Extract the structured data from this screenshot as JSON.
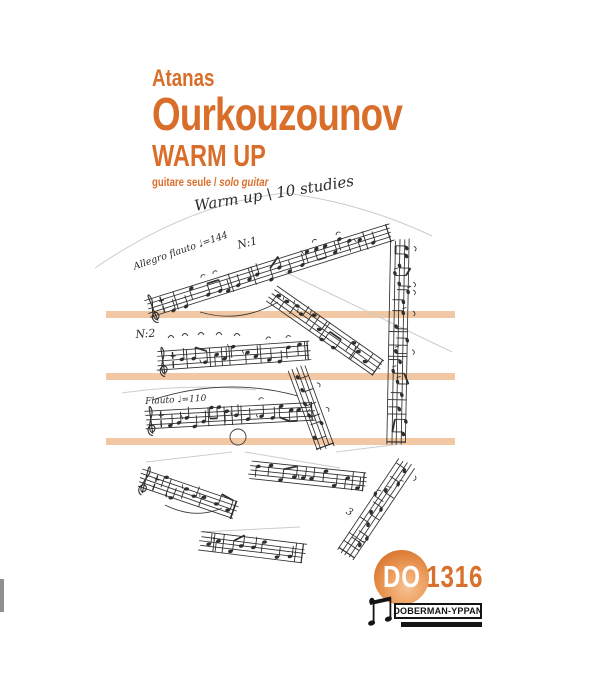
{
  "page": {
    "accent_color": "#d96e2a",
    "band_color": "#f2c7a3",
    "ink_color": "#2e2e2e",
    "background": "#ffffff"
  },
  "header": {
    "author_first": "Atanas",
    "author_last": "Ourkouzounov",
    "title": "WARM UP",
    "subtitle_fr": "guitare seule",
    "subtitle_sep": " / ",
    "subtitle_en": "solo guitar"
  },
  "manuscript": {
    "labels": [
      {
        "text": "Warm up \\ 10 studies",
        "x": 193,
        "y": 197,
        "rot": -9,
        "size": 15
      },
      {
        "text": "N:1",
        "x": 236,
        "y": 239,
        "rot": -14,
        "size": 11
      },
      {
        "text": "Allegro flauto ♩=144",
        "x": 132,
        "y": 262,
        "rot": -19,
        "size": 9.5
      },
      {
        "text": "N:2",
        "x": 135,
        "y": 328,
        "rot": -4,
        "size": 11
      },
      {
        "text": "Flauto ♩=110",
        "x": 145,
        "y": 397,
        "rot": -3,
        "size": 9
      },
      {
        "text": "3",
        "x": 349,
        "y": 506,
        "rot": 28,
        "size": 10
      }
    ],
    "staves": [
      {
        "x": 148,
        "y": 309,
        "angle": -17.5,
        "len": 252,
        "clef": true,
        "seed": 1
      },
      {
        "x": 400,
        "y": 240,
        "angle": 91,
        "len": 202,
        "clef": false,
        "seed": 2
      },
      {
        "x": 271,
        "y": 293,
        "angle": 35,
        "len": 130,
        "clef": false,
        "seed": 3
      },
      {
        "x": 158,
        "y": 361,
        "angle": -4,
        "len": 150,
        "clef": true,
        "seed": 4
      },
      {
        "x": 297,
        "y": 369,
        "angle": 70,
        "len": 82,
        "clef": false,
        "seed": 5
      },
      {
        "x": 146,
        "y": 420,
        "angle": -3,
        "len": 166,
        "clef": true,
        "seed": 6
      },
      {
        "x": 141,
        "y": 478,
        "angle": 19,
        "len": 98,
        "clef": true,
        "seed": 7
      },
      {
        "x": 250,
        "y": 470,
        "angle": 6,
        "len": 114,
        "clef": false,
        "seed": 8
      },
      {
        "x": 407,
        "y": 463,
        "angle": 124,
        "len": 108,
        "clef": false,
        "seed": 9
      },
      {
        "x": 201,
        "y": 541,
        "angle": 7,
        "len": 102,
        "clef": false,
        "seed": 10
      }
    ]
  },
  "footer": {
    "catalog_prefix": "DO",
    "catalog_number": "1316",
    "publisher": "DOBERMAN-YPPAN"
  }
}
